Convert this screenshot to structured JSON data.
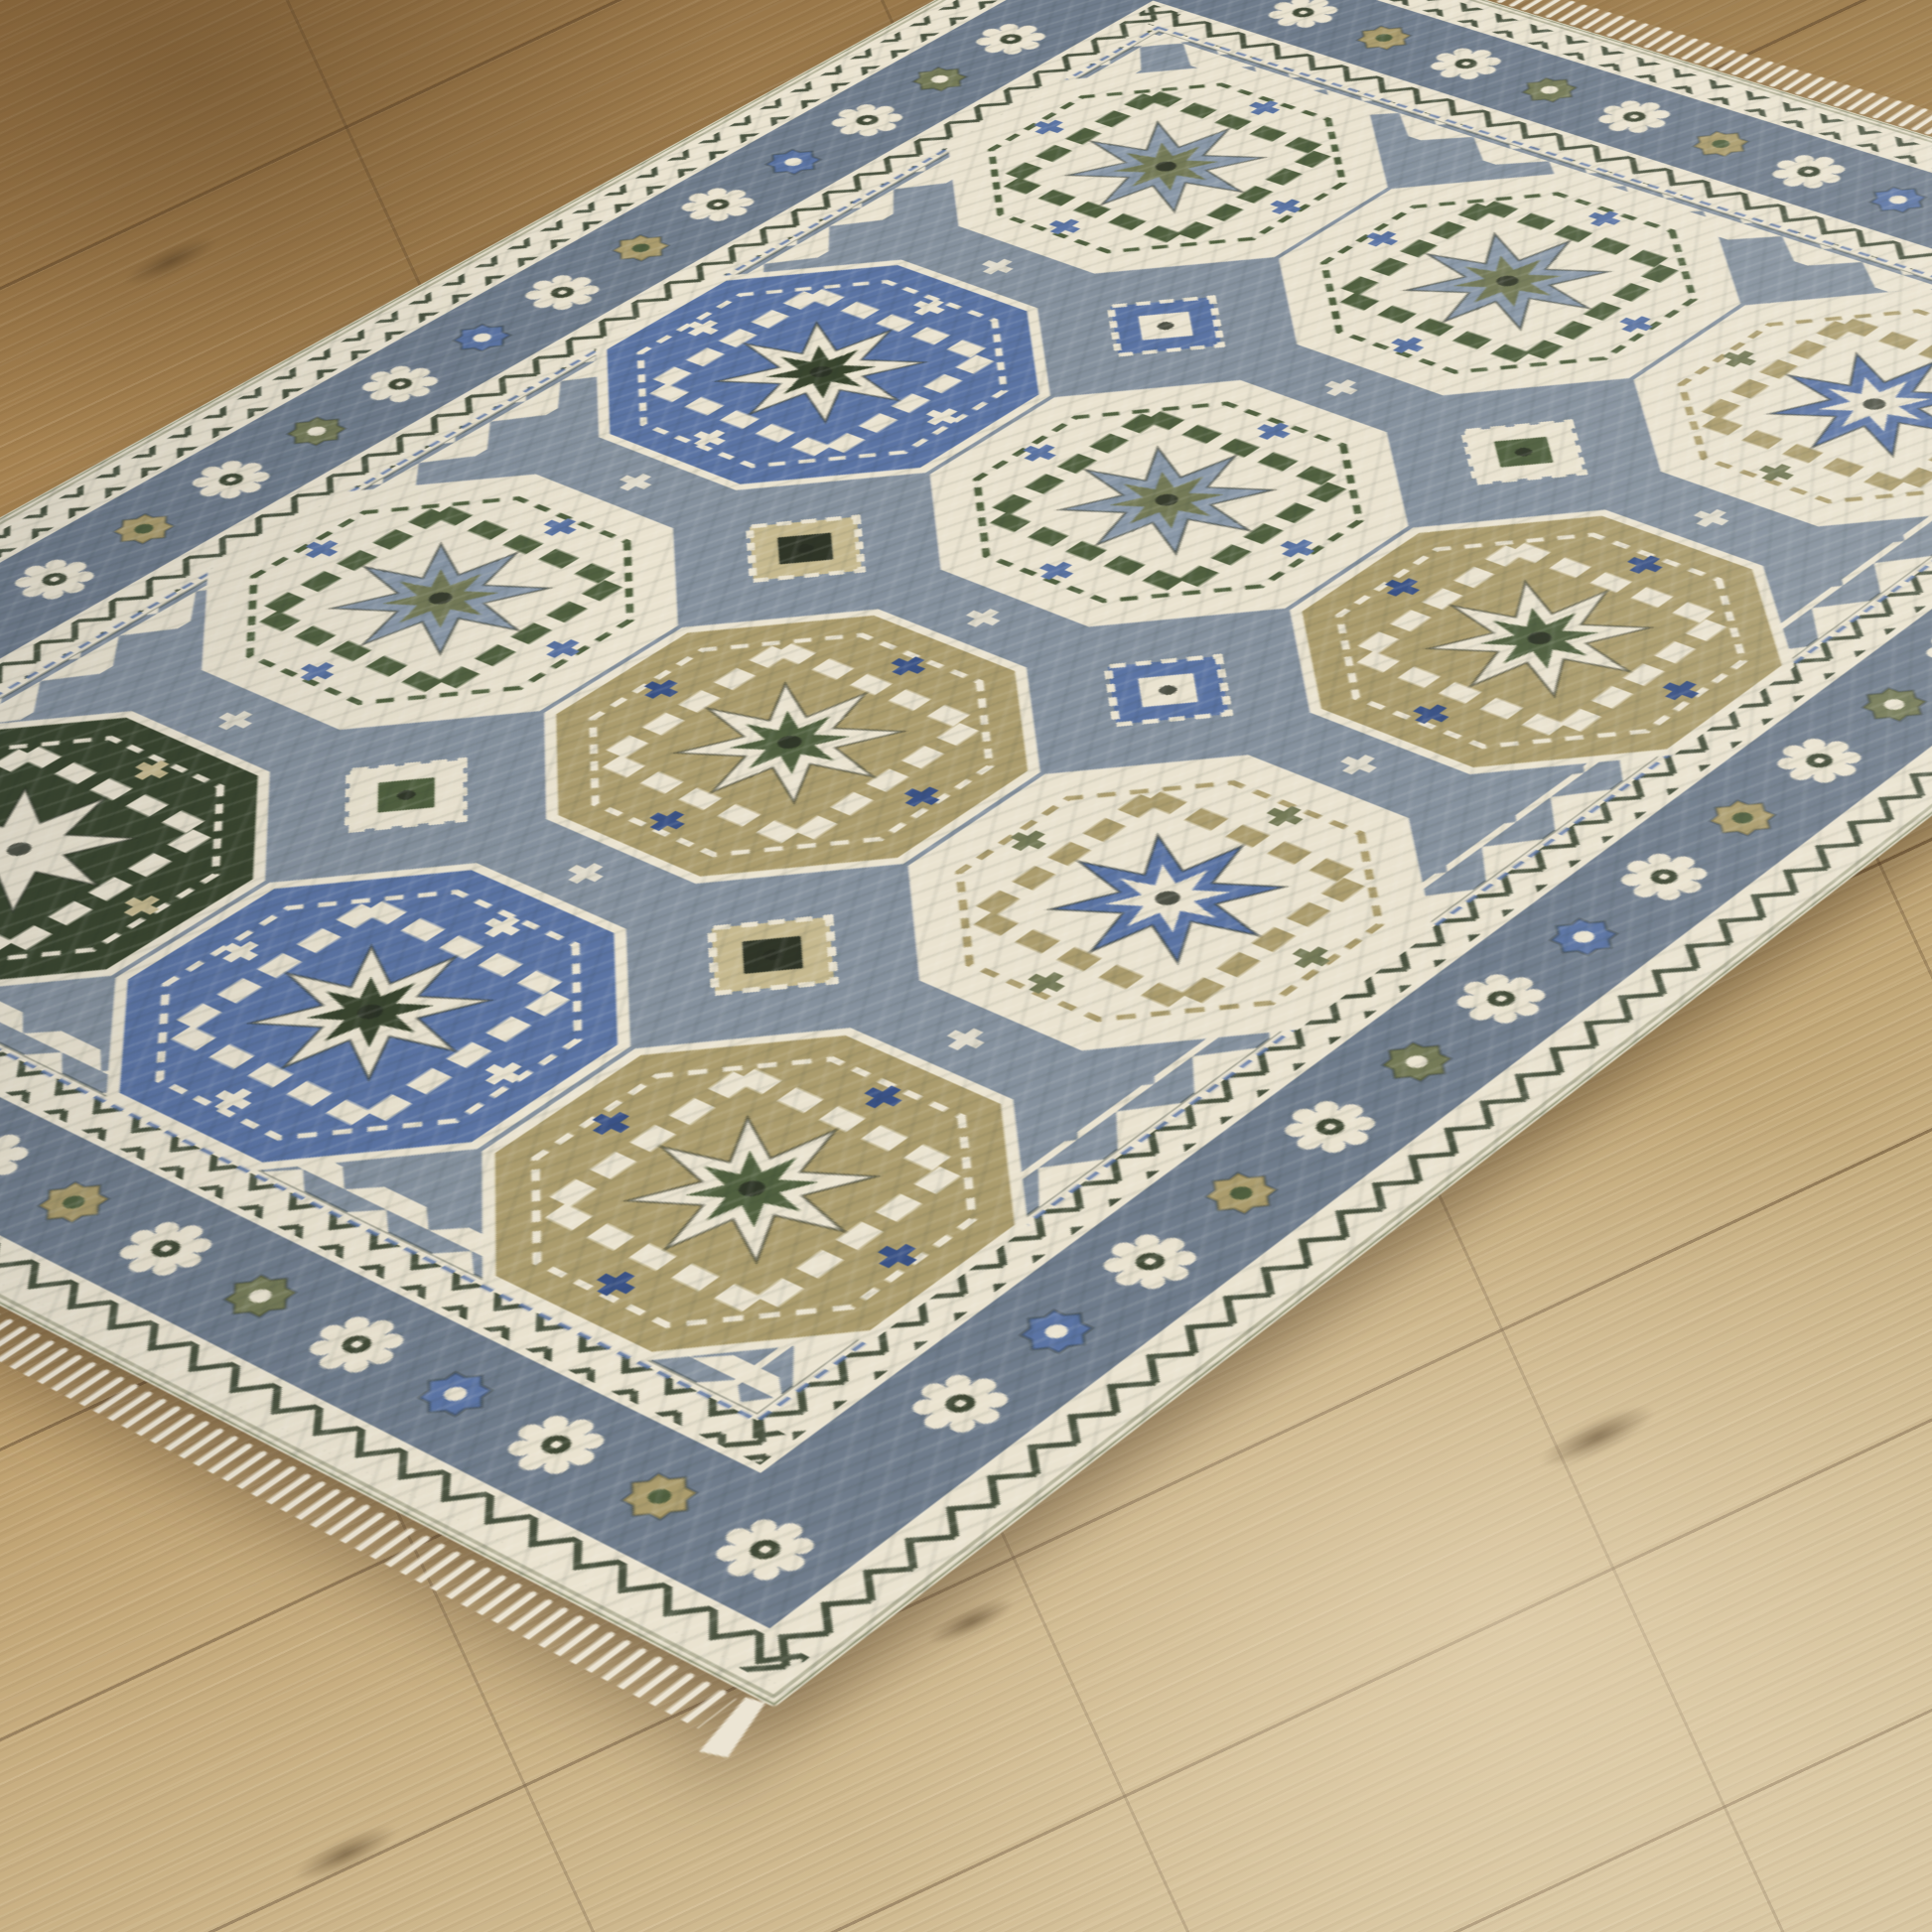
{
  "scene": {
    "description": "Traditional Kazak-style octagon medallion area rug shown at an angle on light oak plank flooring",
    "image_type": "product-photo",
    "visible_text": ""
  },
  "palette": {
    "ivory": "#eae3d0",
    "ivory2": "#d9d0ba",
    "slate": "#85919e",
    "slate2": "#6f7c8c",
    "bgray": "#8b99a9",
    "blue": "#5b74a4",
    "blue2": "#3a5286",
    "green": "#50603f",
    "green2": "#39452e",
    "olive": "#747a57",
    "khaki": "#ab9c6d",
    "tan": "#c6b98f",
    "char": "#2f3527",
    "zig": "#49523f",
    "fringe": "#ece5d4",
    "wood_light": "#d0bd95",
    "wood_mid": "#b79763",
    "wood_dark": "#a07a49",
    "wood_seam": "#6b5134"
  },
  "rug": {
    "style": "kazak-octagon-panel",
    "field_color_key": "slate",
    "medallion_grid": [
      [
        "ivory-green",
        "ivory-green",
        "ivory-tan-blue"
      ],
      [
        "blue",
        "ivory-green",
        "khaki"
      ],
      [
        "ivory-green",
        "khaki",
        "ivory-tan-blue"
      ],
      [
        "dark-green",
        "blue",
        "khaki"
      ]
    ],
    "interstitial_diamonds": [
      "blue",
      "ivory",
      "tan",
      "blue",
      "ivory",
      "tan"
    ],
    "border_bands": [
      "ivory striped binding",
      "ivory zigzag guard",
      "slate rosette-and-cross main border",
      "ivory zigzag inner guard",
      "blue dashed line"
    ],
    "fringed_ends": 2,
    "orientation": "diagonal perspective, bottom corner nearest viewer"
  },
  "floor": {
    "material": "light oak laminate planks",
    "plank_angle_deg": 25,
    "tone_keys": [
      "wood_dark",
      "wood_mid",
      "wood_light"
    ]
  }
}
